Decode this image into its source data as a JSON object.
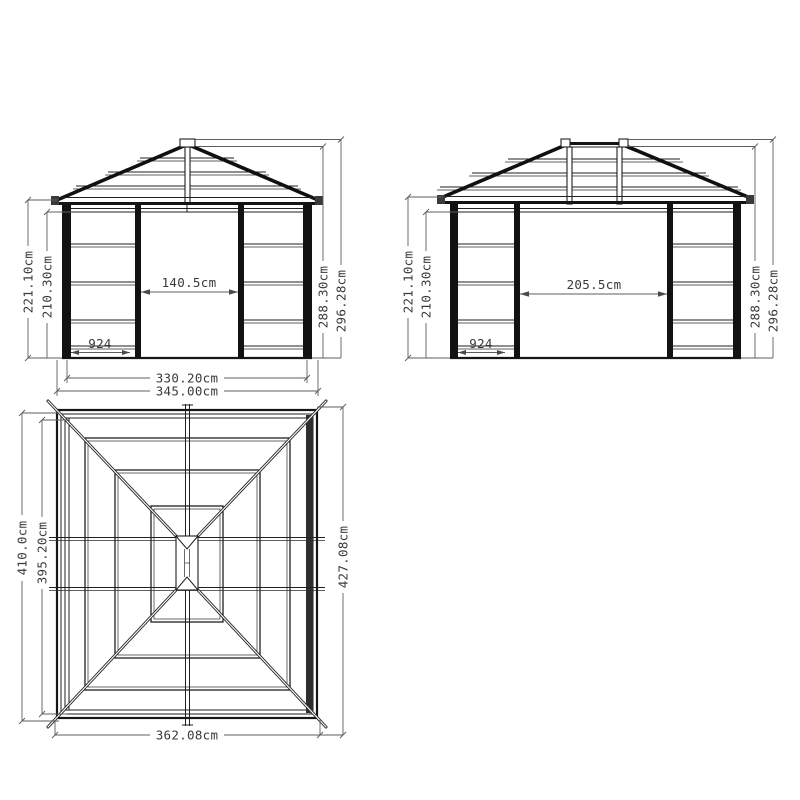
{
  "drawing": {
    "title": "gazebo-technical-drawing",
    "colors": {
      "line": "#1f1f1f",
      "dim_line": "#5d5d5d",
      "text": "#3a3a3a",
      "background": "#ffffff"
    },
    "front_elevation": {
      "height_post": "221.10cm",
      "height_wall": "210.30cm",
      "height_roof": "288.30cm",
      "height_total": "296.28cm",
      "door_width": "140.5cm",
      "panel_code": "924",
      "width_frame": "330.20cm",
      "width_total": "345.00cm"
    },
    "side_elevation": {
      "height_post": "221.10cm",
      "height_wall": "210.30cm",
      "height_roof": "288.30cm",
      "height_total": "296.28cm",
      "door_width": "205.5cm",
      "panel_code": "924"
    },
    "plan_view": {
      "depth_total": "410.0cm",
      "depth_frame": "395.20cm",
      "roof_depth": "427.08cm",
      "roof_width": "362.08cm"
    }
  }
}
